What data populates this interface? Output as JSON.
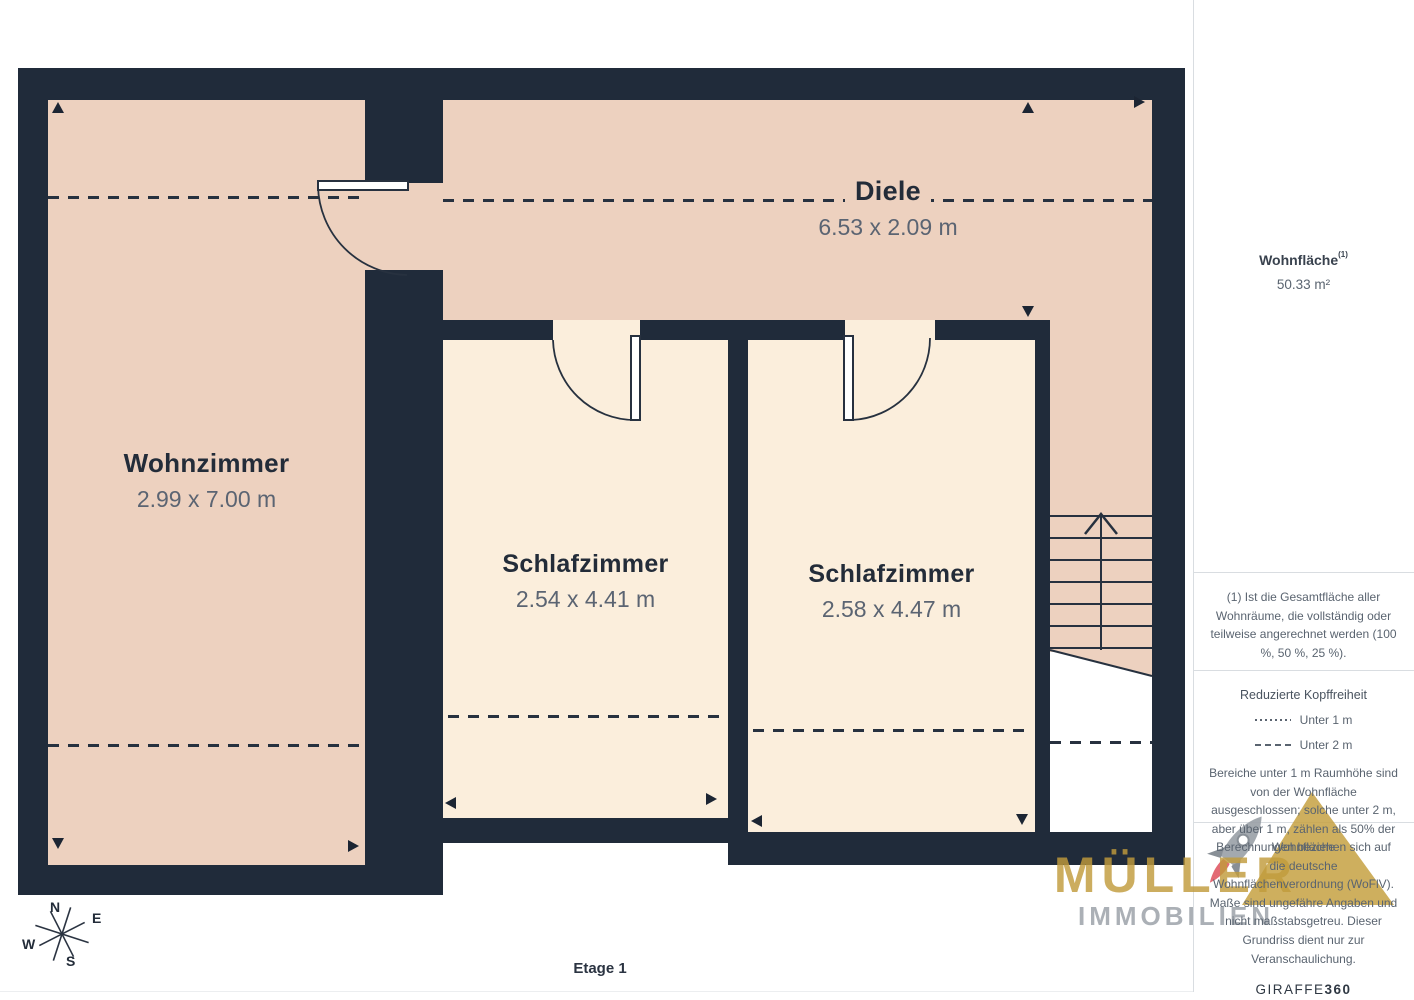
{
  "floorplan": {
    "floor_label": "Etage 1",
    "rooms": [
      {
        "name": "Wohnzimmer",
        "dims": "2.99 x 7.00 m"
      },
      {
        "name": "Diele",
        "dims": "6.53 x 2.09 m"
      },
      {
        "name": "Schlafzimmer",
        "dims": "2.54 x 4.41 m"
      },
      {
        "name": "Schlafzimmer",
        "dims": "2.58 x 4.47 m"
      }
    ],
    "compass": {
      "n": "N",
      "e": "E",
      "s": "S",
      "w": "W"
    }
  },
  "sidebar": {
    "area_label": "Wohnfläche",
    "area_footnote_marker": "(1)",
    "area_value": "50.33 m²",
    "footnote": "(1) Ist die Gesamtfläche aller Wohnräume, die vollständig oder teilweise angerechnet werden (100 %, 50 %, 25 %).",
    "legend_title": "Reduzierte Kopffreiheit",
    "legend_items": [
      {
        "style": "dotted",
        "label": "Unter 1 m"
      },
      {
        "style": "dashed",
        "label": "Unter 2 m"
      }
    ],
    "legend_note": "Bereiche unter 1 m Raumhöhe sind von der Wohnfläche ausgeschlossen; solche unter 2 m, aber über 1 m, zählen als 50% der Wohnfläche",
    "disclaimer": "Berechnungen beziehen sich auf die deutsche Wohnflächenverordnung (WoFlV). Maße sind ungefähre Angaben und nicht maßstabsgetreu. Dieser Grundriss dient nur zur Veranschaulichung.",
    "brand_giraffe": "GIRAFFE",
    "brand_giraffe_suffix": "360"
  },
  "watermark": {
    "line1": "MÜLLER",
    "line2": "IMMOBILIEN"
  },
  "footer": {
    "brand": "Müllerimmobilien®"
  },
  "colors": {
    "wall": "#202B3A",
    "room_warm": "#EDD1BF",
    "room_light": "#FBEEDC",
    "accent_gold": "#C6A244",
    "flame_red": "#E05A66",
    "text_dark": "#232C39",
    "text_gray": "#5A6470"
  }
}
